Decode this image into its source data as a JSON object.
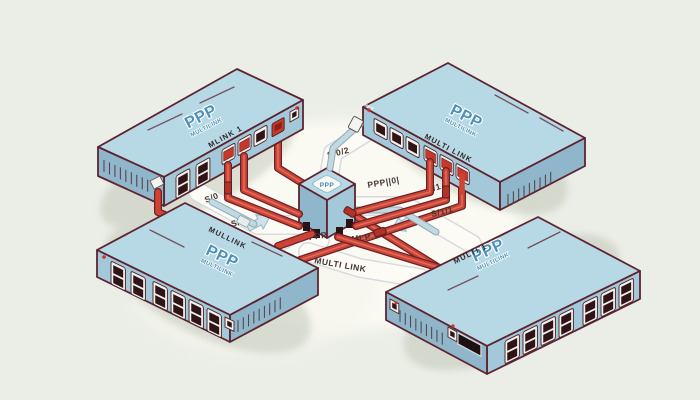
{
  "title": "PPP Multilink isometric network illustration",
  "colors": {
    "background": "#ebeee7",
    "device_top": "#b7d9e6",
    "device_front": "#a3c8d9",
    "device_side": "#8fb6ca",
    "outline": "#5d2430",
    "cable_red": "#ce4434",
    "cable_blue": "#c2d9e2",
    "road_white": "#fcfbf6",
    "label_text": "#473432",
    "logo_blue": "#4e91b8"
  },
  "devices": {
    "router_top_left": {
      "logo": "PPP",
      "logo_sub": "MULTILINK",
      "edge_label": "MLINK 1"
    },
    "router_top_right": {
      "logo": "PPP",
      "logo_sub": "MULTILINK",
      "edge_label": "MULTI LINK",
      "corner_label": "PPP"
    },
    "switch_bottom_left": {
      "logo": "PPP",
      "logo_sub": "MULTILINK",
      "edge_label": "MULLINK"
    },
    "switch_bottom_right": {
      "logo": "PPP",
      "logo_sub": "MULTILINK",
      "edge_label": "MULTI 1"
    }
  },
  "hub": {
    "glyph": "PPP"
  },
  "link_labels": {
    "s0": "S/0",
    "s0_slash": "S/0/",
    "s0_2": "S/0/2",
    "ppp_1_0_1": "PPP||0|",
    "s1": "S/1",
    "s1_1": "S/1/1",
    "pppp": "PPPP",
    "mlp_1": "MLP 1",
    "multi_link": "MULTI LINK"
  }
}
